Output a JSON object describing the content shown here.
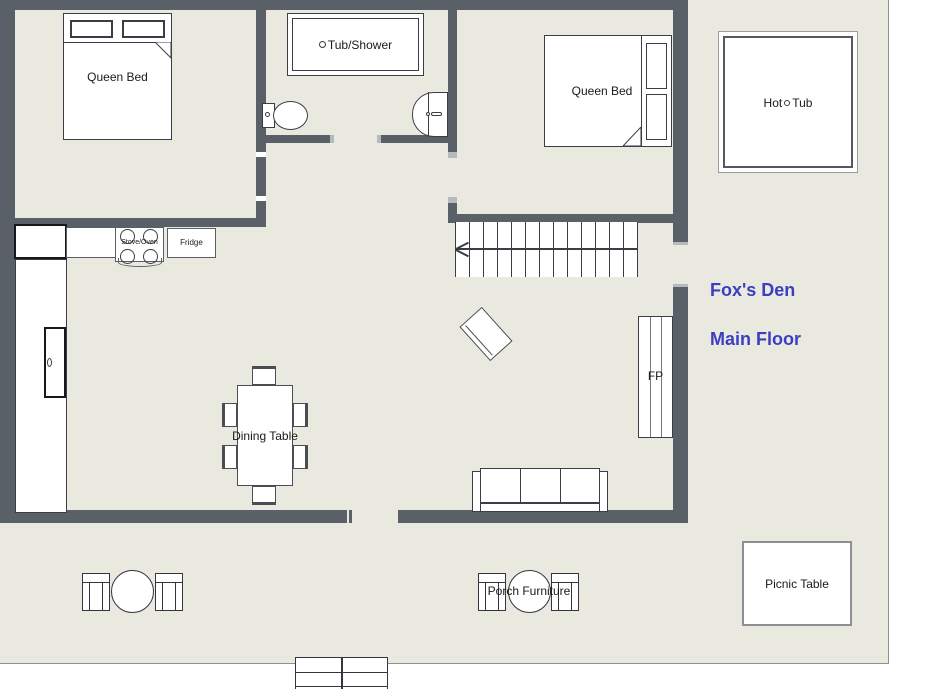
{
  "title": {
    "name": "Fox's Den",
    "floor": "Main Floor"
  },
  "colors": {
    "wall": "#5a6067",
    "floor": "#e9e9e0",
    "title_text": "#3b3ec1"
  },
  "bedroom_left": {
    "bed_label": "Queen Bed"
  },
  "bedroom_right": {
    "bed_label": "Queen Bed"
  },
  "bathroom": {
    "tub_label": "Tub/Shower"
  },
  "kitchen": {
    "stove_label": "Stove/Oven",
    "fridge_label": "Fridge"
  },
  "living_room": {
    "dining_table_label": "Dining Table",
    "fireplace_label": "FP"
  },
  "porch": {
    "hot_tub_word1": "Hot",
    "hot_tub_word2": "Tub",
    "furniture_label": "Porch Furniture",
    "picnic_table_label": "Picnic Table"
  }
}
